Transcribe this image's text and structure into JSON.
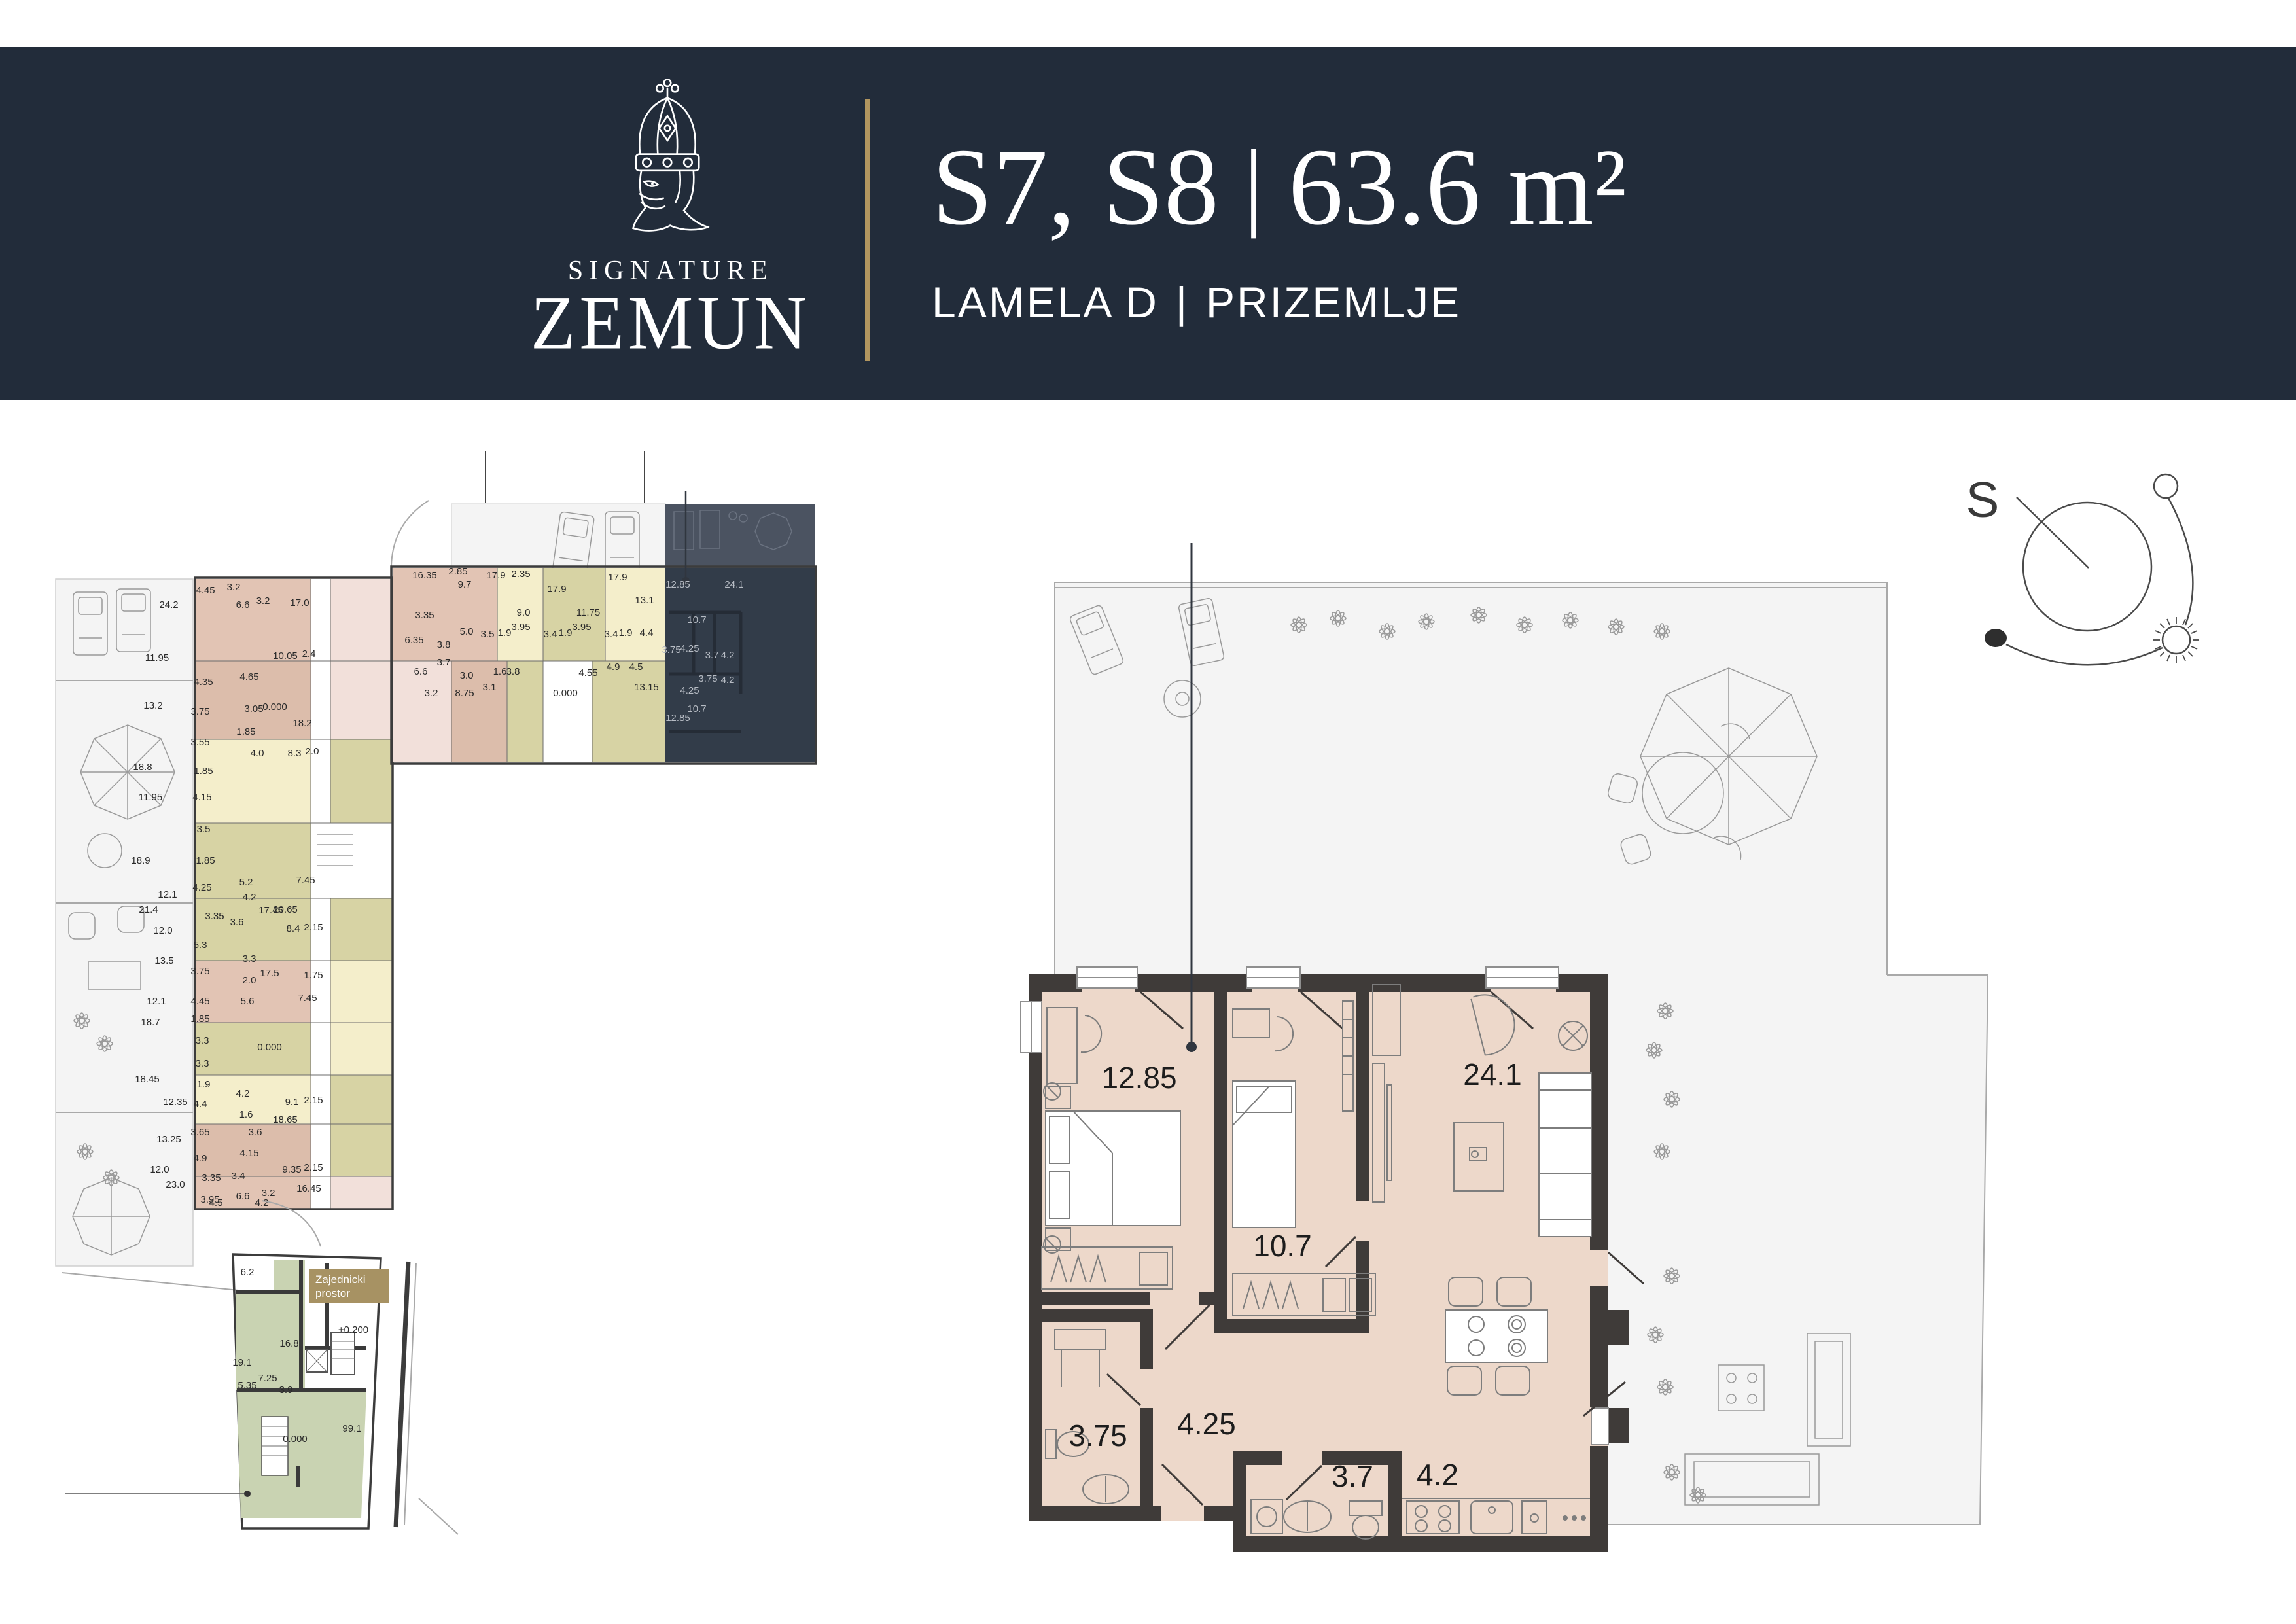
{
  "colors": {
    "header": "#222c3a",
    "accent": "#b2965f",
    "wall": "#3f3b39",
    "beige": "#edd8ca",
    "terr": "#f4f4f4",
    "terrline": "#a9a9a9",
    "rose": "#e2c4b4",
    "rose2": "#dcbdab",
    "cream": "#f4eecb",
    "olive": "#d7d3a4",
    "pink": "#f2e0da",
    "green": "#c9d3b2",
    "dark": "#323c49",
    "dterr": "#4b5361",
    "dwall": "#262c35",
    "dlabel": "#b7bcc4",
    "furn": "#7d7d7d",
    "label": "#1d1d1d",
    "badge": "#a79263"
  },
  "header": {
    "brand_top": "SIGNATURE",
    "brand_name": "ZEMUN",
    "title_units": "S7, S8",
    "title_sep": "|",
    "title_area": "63.6 m²",
    "subtitle_left": "LAMELA D",
    "subtitle_sep": "|",
    "subtitle_right": "PRIZEMLJE"
  },
  "compass": {
    "north_label": "S"
  },
  "main_plan": {
    "room_labels": [
      [
        "12.85",
        1741,
        1663
      ],
      [
        "24.1",
        2281,
        1658
      ],
      [
        "10.7",
        1960,
        1920
      ],
      [
        "4.25",
        1844,
        2192
      ],
      [
        "3.75",
        1678,
        2210
      ],
      [
        "3.7",
        2067,
        2272
      ],
      [
        "4.2",
        2197,
        2270
      ]
    ]
  },
  "plan_left": {
    "labels": [
      [
        "24.2",
        258,
        929
      ],
      [
        "11.95",
        240,
        1010
      ],
      [
        "4.45",
        314,
        907
      ],
      [
        "3.2",
        357,
        902
      ],
      [
        "17.0",
        458,
        926
      ],
      [
        "6.6",
        371,
        929
      ],
      [
        "3.2",
        402,
        923
      ],
      [
        "13.2",
        234,
        1083
      ],
      [
        "4.35",
        311,
        1047
      ],
      [
        "10.05",
        436,
        1007
      ],
      [
        "2.4",
        472,
        1004
      ],
      [
        "4.65",
        381,
        1039
      ],
      [
        "3.75",
        306,
        1092
      ],
      [
        "3.05",
        388,
        1088
      ],
      [
        "18.2",
        462,
        1110
      ],
      [
        "1.85",
        376,
        1123
      ],
      [
        "18.8",
        218,
        1177
      ],
      [
        "3.55",
        306,
        1139
      ],
      [
        "4.0",
        393,
        1156
      ],
      [
        "8.3",
        450,
        1156
      ],
      [
        "2.0",
        477,
        1153
      ],
      [
        "11.95",
        230,
        1223
      ],
      [
        "1.85",
        311,
        1183
      ],
      [
        "4.15",
        309,
        1223
      ],
      [
        "18.9",
        215,
        1320
      ],
      [
        "3.5",
        311,
        1272
      ],
      [
        "1.85",
        314,
        1320
      ],
      [
        "12.1",
        256,
        1372
      ],
      [
        "4.25",
        309,
        1361
      ],
      [
        "5.2",
        376,
        1353
      ],
      [
        "7.45",
        467,
        1350
      ],
      [
        "0.000",
        420,
        1085
      ],
      [
        "0.000",
        412,
        1605
      ],
      [
        "17.45",
        414,
        1396
      ],
      [
        "21.4",
        227,
        1395
      ],
      [
        "12.0",
        249,
        1427
      ],
      [
        "3.35",
        328,
        1405
      ],
      [
        "3.6",
        362,
        1414
      ],
      [
        "5.3",
        306,
        1449
      ],
      [
        "13.5",
        251,
        1473
      ],
      [
        "3.75",
        306,
        1489
      ],
      [
        "4.2",
        381,
        1376
      ],
      [
        "20.65",
        436,
        1395
      ],
      [
        "8.4",
        448,
        1424
      ],
      [
        "2.15",
        479,
        1422
      ],
      [
        "12.1",
        239,
        1535
      ],
      [
        "4.45",
        306,
        1535
      ],
      [
        "3.3",
        381,
        1470
      ],
      [
        "18.7",
        230,
        1567
      ],
      [
        "1.85",
        306,
        1562
      ],
      [
        "17.5",
        412,
        1492
      ],
      [
        "1.75",
        479,
        1495
      ],
      [
        "2.0",
        381,
        1503
      ],
      [
        "3.3",
        309,
        1595
      ],
      [
        "5.6",
        378,
        1535
      ],
      [
        "7.45",
        470,
        1530
      ],
      [
        "3.3",
        309,
        1630
      ],
      [
        "18.45",
        225,
        1654
      ],
      [
        "1.9",
        311,
        1662
      ],
      [
        "12.35",
        268,
        1689
      ],
      [
        "4.4",
        306,
        1692
      ],
      [
        "4.2",
        371,
        1676
      ],
      [
        "9.1",
        446,
        1689
      ],
      [
        "2.15",
        479,
        1686
      ],
      [
        "3.65",
        306,
        1735
      ],
      [
        "1.6",
        376,
        1708
      ],
      [
        "18.65",
        436,
        1716
      ],
      [
        "13.25",
        258,
        1746
      ],
      [
        "3.6",
        390,
        1735
      ],
      [
        "4.9",
        306,
        1775
      ],
      [
        "4.15",
        381,
        1767
      ],
      [
        "12.0",
        244,
        1792
      ],
      [
        "9.35",
        446,
        1792
      ],
      [
        "2.15",
        479,
        1789
      ],
      [
        "3.35",
        323,
        1805
      ],
      [
        "3.4",
        364,
        1802
      ],
      [
        "16.45",
        472,
        1821
      ],
      [
        "23.0",
        268,
        1815
      ],
      [
        "3.95",
        321,
        1838
      ],
      [
        "6.6",
        371,
        1833
      ],
      [
        "3.2",
        410,
        1828
      ],
      [
        "4.5",
        330,
        1843
      ],
      [
        "4.2",
        400,
        1843
      ]
    ]
  },
  "plan_middle": {
    "labels_light": [
      [
        "16.35",
        649,
        884
      ],
      [
        "2.85",
        700,
        878
      ],
      [
        "17.9",
        758,
        884
      ],
      [
        "2.35",
        796,
        882
      ],
      [
        "17.9",
        851,
        905
      ],
      [
        "17.9",
        944,
        887
      ],
      [
        "9.7",
        710,
        898
      ],
      [
        "13.1",
        985,
        922
      ],
      [
        "9.0",
        800,
        941
      ],
      [
        "11.75",
        899,
        941
      ],
      [
        "3.35",
        649,
        945
      ],
      [
        "5.0",
        713,
        970
      ],
      [
        "3.5",
        745,
        974
      ],
      [
        "1.9",
        771,
        972
      ],
      [
        "3.95",
        796,
        963
      ],
      [
        "3.4",
        841,
        974
      ],
      [
        "1.9",
        864,
        972
      ],
      [
        "3.95",
        889,
        963
      ],
      [
        "3.4",
        934,
        974
      ],
      [
        "1.9",
        956,
        972
      ],
      [
        "4.4",
        988,
        972
      ],
      [
        "6.35",
        633,
        983
      ],
      [
        "3.8",
        678,
        990
      ],
      [
        "3.7",
        678,
        1017
      ],
      [
        "6.6",
        643,
        1031
      ],
      [
        "3.0",
        713,
        1037
      ],
      [
        "3.2",
        659,
        1064
      ],
      [
        "8.75",
        710,
        1064
      ],
      [
        "3.1",
        748,
        1055
      ],
      [
        "1.6",
        764,
        1031
      ],
      [
        "3.8",
        784,
        1031
      ],
      [
        "0.000",
        864,
        1064
      ],
      [
        "4.55",
        899,
        1033
      ],
      [
        "4.9",
        937,
        1024
      ],
      [
        "4.5",
        972,
        1024
      ],
      [
        "13.15",
        988,
        1055
      ]
    ],
    "labels_dark": [
      [
        "12.85",
        1036,
        898
      ],
      [
        "24.1",
        1122,
        898
      ],
      [
        "10.7",
        1065,
        952
      ],
      [
        "3.75",
        1026,
        998
      ],
      [
        "4.25",
        1054,
        996
      ],
      [
        "3.7",
        1088,
        1006
      ],
      [
        "4.2",
        1112,
        1006
      ],
      [
        "3.75",
        1082,
        1042
      ],
      [
        "4.2",
        1112,
        1044
      ],
      [
        "4.25",
        1054,
        1060
      ],
      [
        "10.7",
        1065,
        1088
      ],
      [
        "12.85",
        1036,
        1102
      ]
    ]
  },
  "plan_common": {
    "badge_line1": "Zajednicki",
    "badge_line2": "prostor",
    "labels": [
      [
        "6.2",
        378,
        1949
      ],
      [
        "16.8",
        442,
        2058
      ],
      [
        "19.1",
        370,
        2087
      ],
      [
        "7.25",
        409,
        2111
      ],
      [
        "5.35",
        378,
        2122
      ],
      [
        "3.9",
        437,
        2129
      ],
      [
        "0.000",
        451,
        2204
      ],
      [
        "99.1",
        538,
        2188
      ],
      [
        "+0.200",
        540,
        2037
      ]
    ]
  }
}
